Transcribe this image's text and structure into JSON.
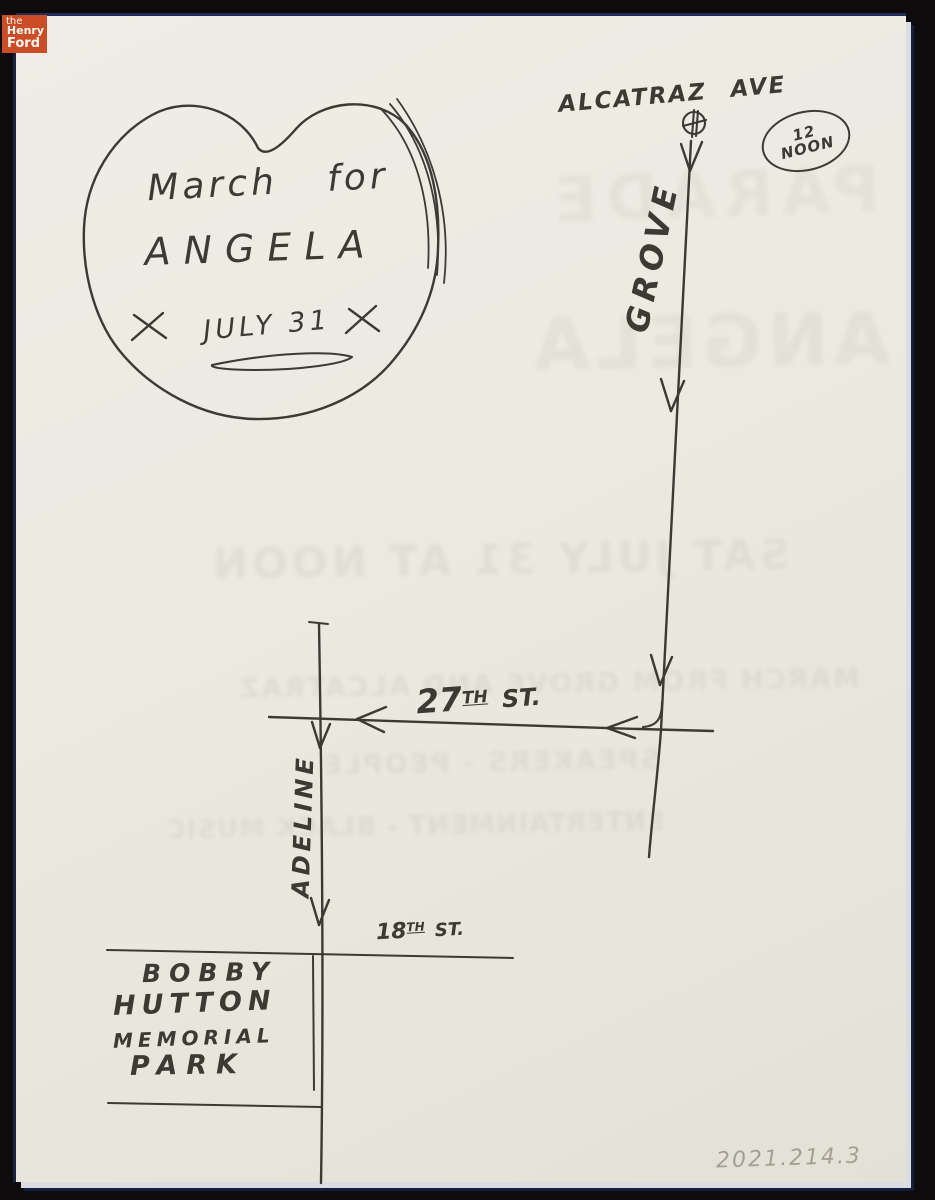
{
  "archive": {
    "logo": {
      "word_the": "the",
      "word_henry": "Henry",
      "word_ford": "Ford"
    },
    "accession_number": "2021.214.3"
  },
  "map": {
    "title_bubble": {
      "line1": "March for",
      "line2": "ANGELA",
      "line3": "JULY 31"
    },
    "labels": {
      "alcatraz_ave": "ALCATRAZ AVE",
      "noon_line1": "12",
      "noon_line2": "NOON",
      "grove": "GROVE",
      "street27": {
        "num": "27",
        "sup": "TH",
        "word": "ST."
      },
      "adeline": "ADELINE",
      "street18": {
        "num": "18",
        "sup": "TH",
        "word": "ST."
      },
      "park": {
        "line1": "BOBBY",
        "line2": "HUTTON",
        "line3": "MEMORIAL",
        "line4": "PARK"
      }
    },
    "bleed_through": [
      "PARADE",
      "ANGELA",
      "SAT JULY 31 AT NOON",
      "MARCH FROM GROVE AND ALCATRAZ",
      "SPEAKERS - PEOPLE",
      "ENTERTAINMENT - BLACK MUSIC"
    ]
  },
  "colors": {
    "ink": "#3b3a33",
    "paper": "#ebe9e0",
    "scan_background": "#0d0b0c",
    "logo_badge": "#cb4d27",
    "pencil": "#a49f92"
  }
}
